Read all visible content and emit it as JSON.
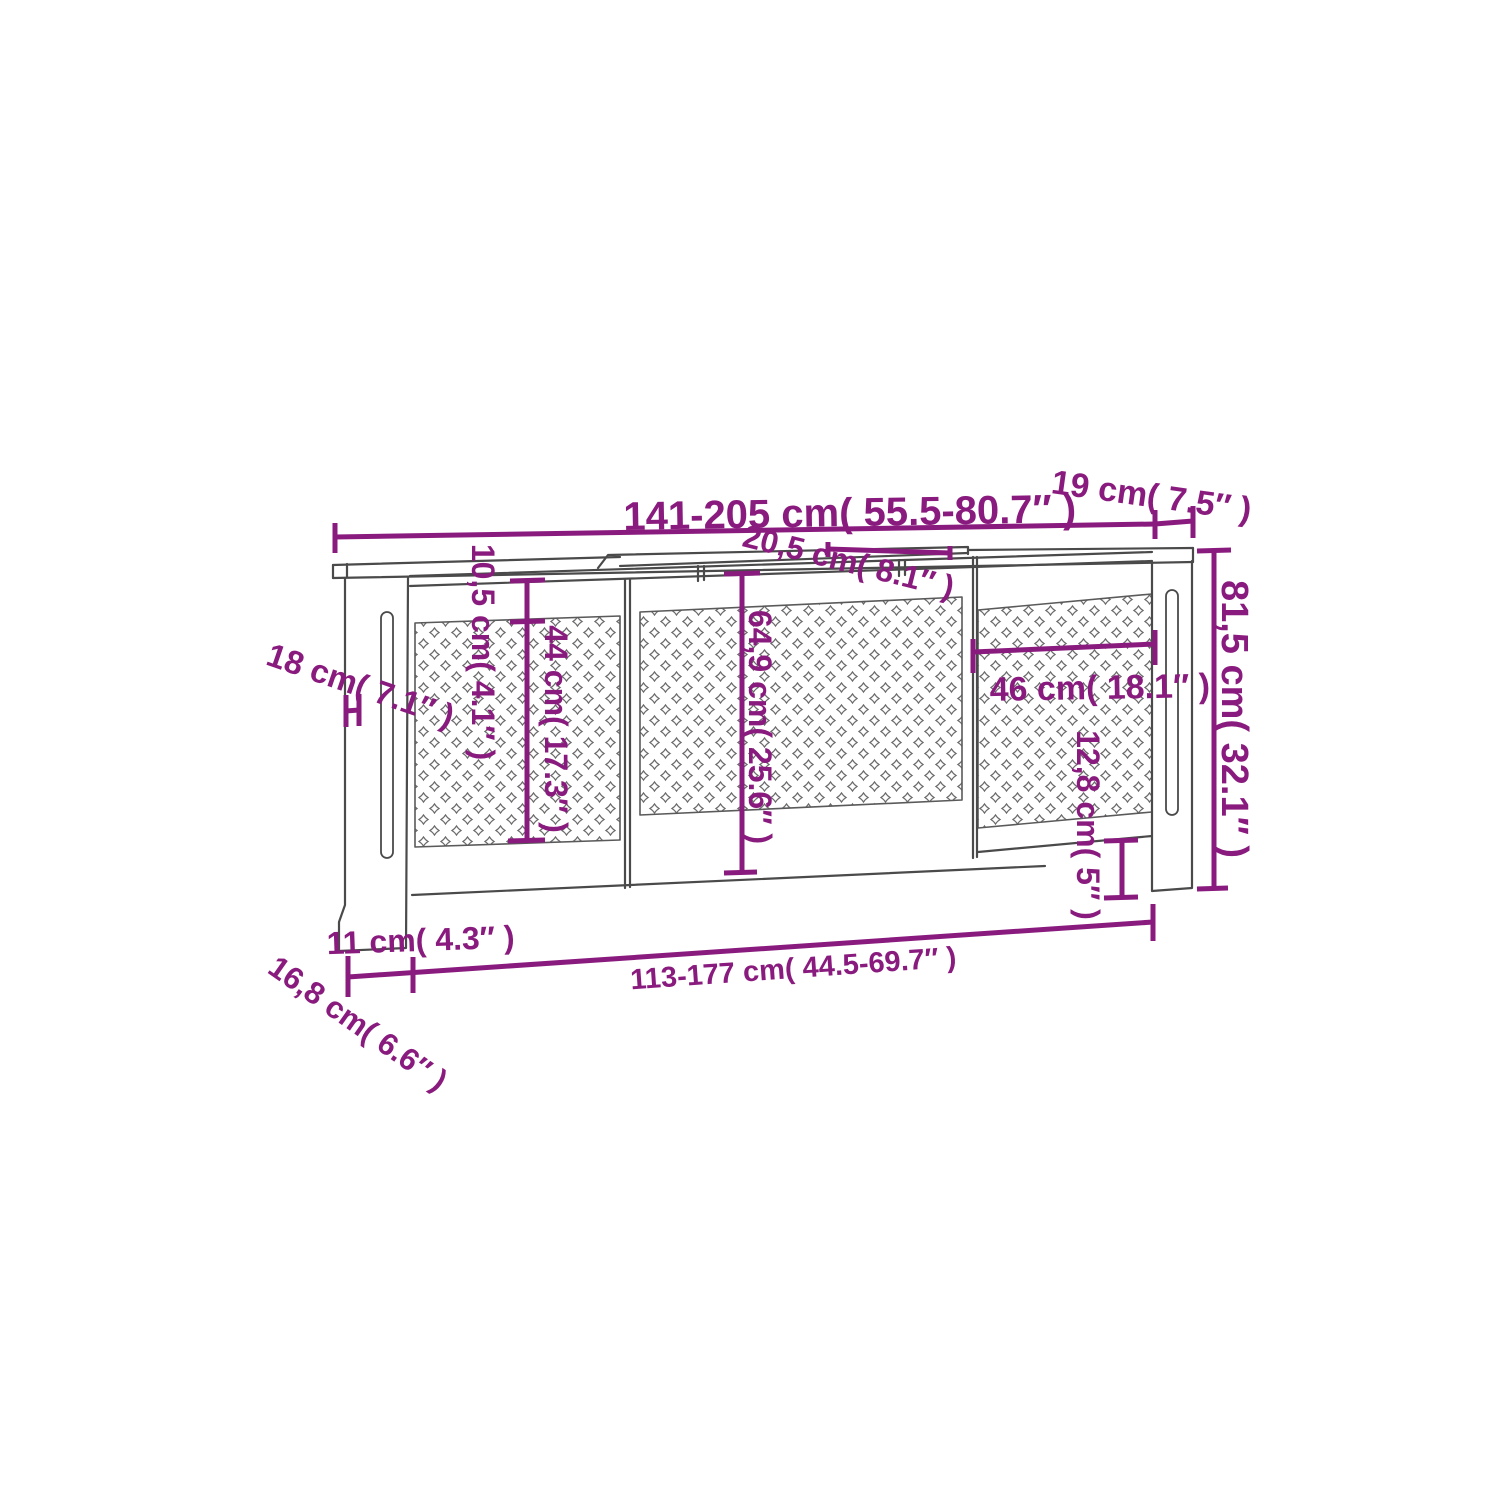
{
  "page": {
    "background": "#ffffff",
    "description_label": "Radiator cover dimension diagram"
  },
  "colors": {
    "annotation": "#8A1B7E",
    "outline": "#4a4a4a",
    "lattice": "#6b6b6b"
  },
  "diagram": {
    "line_width": 5,
    "dimensions": [
      {
        "id": "top-width",
        "label": "141-205 cm( 55.5-80.7″ )",
        "text": {
          "x": 850,
          "y": 526,
          "rotate": -1,
          "size": 40
        },
        "lines": [
          [
            335,
            537,
            1155,
            524
          ],
          [
            335,
            523,
            335,
            553
          ],
          [
            1155,
            510,
            1155,
            539
          ]
        ]
      },
      {
        "id": "top-depth",
        "label": "19 cm( 7.5″ )",
        "text": {
          "x": 1150,
          "y": 507,
          "rotate": 8,
          "size": 34
        },
        "lines": [
          [
            1155,
            524,
            1193,
            521
          ],
          [
            1193,
            506,
            1193,
            538
          ]
        ]
      },
      {
        "id": "middle-lid-depth",
        "label": "20,5 cm( 8.1″ )",
        "text": {
          "x": 846,
          "y": 572,
          "rotate": 14,
          "size": 32
        },
        "lines": [
          [
            828,
            549,
            950,
            553
          ],
          [
            828,
            542,
            828,
            557
          ],
          [
            950,
            546,
            950,
            560
          ]
        ]
      },
      {
        "id": "top-gap-height",
        "label": "10,5 cm( 4.1″ )",
        "text": {
          "x": 472,
          "y": 652,
          "rotate": 90,
          "size": 32
        },
        "lines": [
          [
            527,
            581,
            527,
            621
          ],
          [
            510,
            581,
            545,
            580
          ],
          [
            510,
            622,
            545,
            621
          ]
        ]
      },
      {
        "id": "side-panel-height",
        "label": "44 cm( 17.3″ )",
        "text": {
          "x": 545,
          "y": 729,
          "rotate": 90,
          "size": 32
        },
        "lines": [
          [
            527,
            622,
            527,
            840
          ],
          [
            508,
            841,
            545,
            840
          ]
        ]
      },
      {
        "id": "center-panel-height",
        "label": "64,9 cm( 25.6″ )",
        "text": {
          "x": 749,
          "y": 727,
          "rotate": 90,
          "size": 32
        },
        "lines": [
          [
            742,
            575,
            742,
            872
          ],
          [
            724,
            574,
            760,
            573
          ],
          [
            724,
            873,
            757,
            872
          ]
        ]
      },
      {
        "id": "side-depth",
        "label": "18 cm( 7.1″ )",
        "text": {
          "x": 357,
          "y": 696,
          "rotate": 19,
          "size": 33
        },
        "lines": [
          [
            346,
            695,
            346,
            727
          ],
          [
            359,
            694,
            359,
            726
          ],
          [
            346,
            711,
            359,
            710
          ]
        ]
      },
      {
        "id": "total-height",
        "label": "81,5 cm( 32.1″ )",
        "text": {
          "x": 1222,
          "y": 719,
          "rotate": 90,
          "size": 38
        },
        "lines": [
          [
            1214,
            551,
            1214,
            888
          ],
          [
            1197,
            551,
            1231,
            550
          ],
          [
            1197,
            889,
            1228,
            888
          ]
        ]
      },
      {
        "id": "right-panel-width",
        "label": "46 cm( 18.1″ )",
        "text": {
          "x": 1100,
          "y": 699,
          "rotate": -1,
          "size": 34
        },
        "lines": [
          [
            973,
            652,
            1155,
            644
          ],
          [
            973,
            639,
            973,
            673
          ],
          [
            1155,
            630,
            1155,
            665
          ]
        ]
      },
      {
        "id": "bottom-gap-height",
        "label": "12,8 cm( 5″ )",
        "text": {
          "x": 1077,
          "y": 825,
          "rotate": 90,
          "size": 32
        },
        "lines": [
          [
            1122,
            841,
            1122,
            897
          ],
          [
            1104,
            841,
            1138,
            840
          ],
          [
            1104,
            898,
            1138,
            897
          ]
        ]
      },
      {
        "id": "foot-offset",
        "label": "11 cm( 4.3″ )",
        "text": {
          "x": 421,
          "y": 951,
          "rotate": -2,
          "size": 32
        },
        "lines": [
          [
            413,
            957,
            413,
            993
          ]
        ]
      },
      {
        "id": "base-depth",
        "label": "16,8 cm( 6.6″ )",
        "text": {
          "x": 352,
          "y": 1032,
          "rotate": 35,
          "size": 31
        },
        "lines": []
      },
      {
        "id": "bottom-width",
        "label": "113-177 cm( 44.5-69.7″ )",
        "text": {
          "x": 794,
          "y": 978,
          "rotate": -4,
          "size": 29
        },
        "lines": [
          [
            348,
            977,
            1153,
            922
          ],
          [
            348,
            956,
            348,
            997
          ],
          [
            1153,
            904,
            1153,
            941
          ]
        ]
      }
    ]
  }
}
